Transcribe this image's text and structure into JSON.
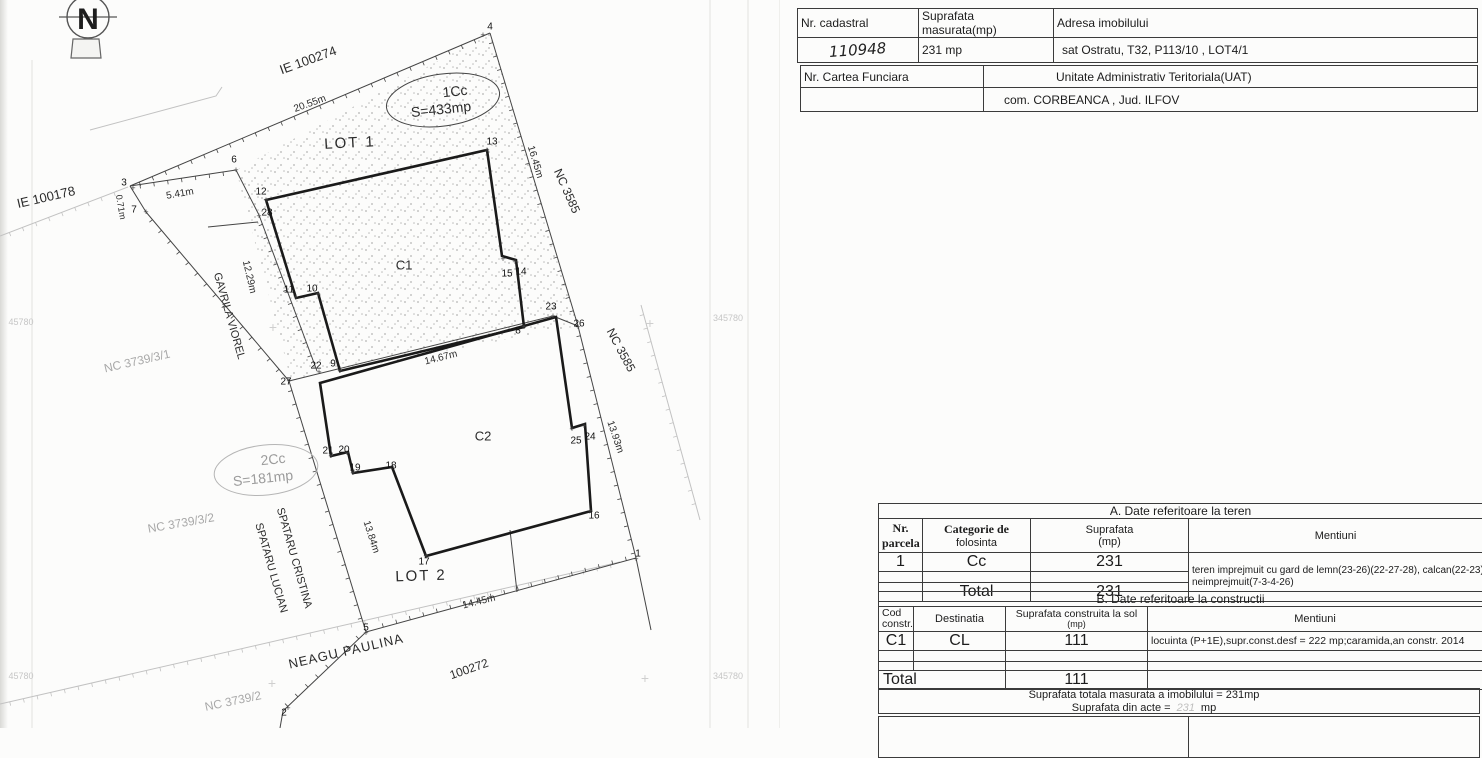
{
  "header_tables": {
    "t1": {
      "headers": [
        "Nr.  cadastral",
        "Suprafata  masurata(mp)",
        "Adresa  imobilului"
      ],
      "values": {
        "nr_cadastral": "110948",
        "suprafata": "231 mp",
        "adresa": "sat Ostratu, T32, P113/10 , LOT4/1"
      }
    },
    "t2": {
      "headers": [
        "Nr. Cartea  Funciara",
        "Unitate Administrativ Teritoriala(UAT)"
      ],
      "values": {
        "cartea_funciara": "",
        "uat": "com. CORBEANCA , Jud. ILFOV"
      }
    }
  },
  "teren": {
    "title": "A.  Date referitoare la teren",
    "col_headers": {
      "nr": [
        "Nr.",
        "parcela"
      ],
      "categorie": [
        "Categorie de",
        "folosinta"
      ],
      "suprafata": [
        "Suprafata",
        "(mp)"
      ],
      "mentiuni": "Mentiuni"
    },
    "row": {
      "nr": "1",
      "categorie": "Cc",
      "suprafata": "231"
    },
    "mentiuni_line1": "teren imprejmuit cu gard de lemn(23-26)(22-27-28), calcan(22-23)(28-6-7) si",
    "mentiuni_line2": "neimprejmuit(7-3-4-26)",
    "total_label": "Total",
    "total": "231"
  },
  "constructii": {
    "title": "B.  Date referitoare la constructii",
    "col_headers": {
      "cod": [
        "Cod",
        "constr."
      ],
      "destinatia": "Destinatia",
      "suprafata": [
        "Suprafata construita la sol",
        "(mp)"
      ],
      "mentiuni": "Mentiuni"
    },
    "row": {
      "cod": "C1",
      "destinatia": "CL",
      "suprafata": "111",
      "mentiuni": "locuinta (P+1E),supr.const.desf = 222 mp;caramida,an constr. 2014"
    },
    "total_label": "Total",
    "total": "111"
  },
  "summary": {
    "line1": "Suprafata  totala  masurata a imobilului =  231mp",
    "line2_prefix": "Suprafata  din  acte =",
    "line2_value": "231",
    "line2_suffix": "mp"
  },
  "map": {
    "north_letter": "N",
    "colors": {
      "ink": "#1a1a1a",
      "boundary": "#444444",
      "faint": "#c2c2c2",
      "gray_text": "#a8a8a8"
    },
    "labels": [
      {
        "text": "IE 100274",
        "x": 308,
        "y": 60,
        "rot": -20,
        "size": 13,
        "name": "neighbor-id-ie100274"
      },
      {
        "text": "20.55m",
        "x": 310,
        "y": 104,
        "rot": -20,
        "size": 10,
        "name": "dim-20-55"
      },
      {
        "text": "LOT 1",
        "x": 350,
        "y": 143,
        "rot": -3,
        "size": 15,
        "ls": 2,
        "name": "lot1-label"
      },
      {
        "text": "IE 100178",
        "x": 46,
        "y": 197,
        "rot": -13,
        "size": 13,
        "name": "neighbor-id-ie100178"
      },
      {
        "text": "5.41m",
        "x": 180,
        "y": 194,
        "rot": -10,
        "size": 10,
        "name": "dim-5-41"
      },
      {
        "text": "0.71m",
        "x": 121,
        "y": 207,
        "rot": 80,
        "size": 9,
        "name": "dim-0-71"
      },
      {
        "text": "12.29m",
        "x": 249,
        "y": 277,
        "rot": 77,
        "size": 10,
        "name": "dim-12-29"
      },
      {
        "text": "GAVRILA VIOREL",
        "x": 229,
        "y": 316,
        "rot": 74,
        "size": 11,
        "name": "neighbor-gavrila-viorel"
      },
      {
        "text": "NC 3739/3/1",
        "x": 137,
        "y": 361,
        "rot": -13,
        "size": 12,
        "color": "#a8a8a8",
        "name": "neighbor-id-nc3739-3-1"
      },
      {
        "text": "16.45m",
        "x": 535,
        "y": 162,
        "rot": 73,
        "size": 10,
        "name": "dim-16-45"
      },
      {
        "text": "NC 3585",
        "x": 567,
        "y": 191,
        "rot": 66,
        "size": 12,
        "name": "neighbor-id-nc3585-a"
      },
      {
        "text": "NC 3585",
        "x": 621,
        "y": 350,
        "rot": 62,
        "size": 12,
        "name": "neighbor-id-nc3585-b"
      },
      {
        "text": "13.93m",
        "x": 615,
        "y": 437,
        "rot": 71,
        "size": 10,
        "name": "dim-13-93"
      },
      {
        "text": "C1",
        "x": 404,
        "y": 265,
        "rot": 0,
        "size": 13,
        "name": "building-c1-label"
      },
      {
        "text": "C2",
        "x": 483,
        "y": 436,
        "rot": 0,
        "size": 13,
        "name": "building-c2-label"
      },
      {
        "text": "14.67m",
        "x": 441,
        "y": 358,
        "rot": -14,
        "size": 10,
        "name": "dim-14-67"
      },
      {
        "text": "1Cc",
        "x": 455,
        "y": 91,
        "rot": -6,
        "size": 14,
        "name": "parcel-1cc-label"
      },
      {
        "text": "S=433mp",
        "x": 441,
        "y": 109,
        "rot": -6,
        "size": 14,
        "name": "parcel-1cc-area"
      },
      {
        "text": "2Cc",
        "x": 273,
        "y": 459,
        "rot": -6,
        "size": 14,
        "color": "#9b9b9b",
        "name": "parcel-2cc-label"
      },
      {
        "text": "S=181mp",
        "x": 263,
        "y": 478,
        "rot": -6,
        "size": 14,
        "color": "#9b9b9b",
        "name": "parcel-2cc-area"
      },
      {
        "text": "SPATARU CRISTINA",
        "x": 294,
        "y": 558,
        "rot": 74,
        "size": 11,
        "name": "neighbor-spataru-cristina"
      },
      {
        "text": "SPATARU LUCIAN",
        "x": 271,
        "y": 568,
        "rot": 74,
        "size": 11,
        "name": "neighbor-spataru-lucian"
      },
      {
        "text": "13.84m",
        "x": 371,
        "y": 537,
        "rot": 72,
        "size": 10,
        "name": "dim-13-84"
      },
      {
        "text": "LOT 2",
        "x": 421,
        "y": 576,
        "rot": -2,
        "size": 15,
        "ls": 2,
        "name": "lot2-label"
      },
      {
        "text": "14.45m",
        "x": 479,
        "y": 602,
        "rot": -14,
        "size": 10,
        "name": "dim-14-45"
      },
      {
        "text": "NEAGU PAULINA",
        "x": 346,
        "y": 651,
        "rot": -13,
        "size": 13,
        "ls": 1,
        "name": "neighbor-neagu-paulina"
      },
      {
        "text": "100272",
        "x": 469,
        "y": 669,
        "rot": -19,
        "size": 12,
        "name": "neighbor-id-100272"
      },
      {
        "text": "NC 3739/2",
        "x": 233,
        "y": 701,
        "rot": -12,
        "size": 12,
        "color": "#a8a8a8",
        "name": "neighbor-id-nc3739-2"
      },
      {
        "text": "NC 3739/3/2",
        "x": 181,
        "y": 523,
        "rot": -10,
        "size": 12,
        "color": "#a8a8a8",
        "name": "neighbor-id-nc3739-3-2"
      },
      {
        "text": "45780",
        "x": 21,
        "y": 322,
        "rot": 0,
        "size": 9,
        "color": "#c6c6c6",
        "name": "grid-coord-label"
      },
      {
        "text": "45780",
        "x": 21,
        "y": 676,
        "rot": 0,
        "size": 9,
        "color": "#c6c6c6",
        "name": "grid-coord-label"
      },
      {
        "text": "345780",
        "x": 728,
        "y": 318,
        "rot": 0,
        "size": 9,
        "color": "#c6c6c6",
        "name": "grid-coord-label"
      },
      {
        "text": "345780",
        "x": 728,
        "y": 676,
        "rot": 0,
        "size": 9,
        "color": "#c6c6c6",
        "name": "grid-coord-label"
      },
      {
        "text": "+",
        "x": 273,
        "y": 327,
        "rot": 0,
        "size": 14,
        "color": "#cfcfcf",
        "name": "grid-cross"
      },
      {
        "text": "+",
        "x": 650,
        "y": 323,
        "rot": 0,
        "size": 14,
        "color": "#cfcfcf",
        "name": "grid-cross"
      },
      {
        "text": "+",
        "x": 272,
        "y": 683,
        "rot": 0,
        "size": 14,
        "color": "#cfcfcf",
        "name": "grid-cross"
      },
      {
        "text": "+",
        "x": 645,
        "y": 678,
        "rot": 0,
        "size": 14,
        "color": "#cfcfcf",
        "name": "grid-cross"
      }
    ],
    "vertices": [
      {
        "n": "3",
        "lx": 124,
        "ly": 183,
        "px": 133,
        "py": 188
      },
      {
        "n": "7",
        "lx": 134,
        "ly": 210,
        "px": 146,
        "py": 212
      },
      {
        "n": "6",
        "lx": 234,
        "ly": 160,
        "px": 236,
        "py": 170
      },
      {
        "n": "4",
        "lx": 490,
        "ly": 27,
        "px": 483,
        "py": 35
      },
      {
        "n": "13",
        "lx": 492,
        "ly": 142,
        "px": 487,
        "py": 150
      },
      {
        "n": "12",
        "lx": 261,
        "ly": 192,
        "px": 266,
        "py": 200
      },
      {
        "n": "28",
        "lx": 267,
        "ly": 213,
        "px": 259,
        "py": 216
      },
      {
        "n": "11",
        "lx": 289,
        "ly": 290,
        "px": 296,
        "py": 297
      },
      {
        "n": "10",
        "lx": 312,
        "ly": 289,
        "px": 318,
        "py": 294
      },
      {
        "n": "15",
        "lx": 507,
        "ly": 274,
        "px": 503,
        "py": 259
      },
      {
        "n": "14",
        "lx": 521,
        "ly": 272,
        "px": 515,
        "py": 262
      },
      {
        "n": "8",
        "lx": 518,
        "ly": 331,
        "px": 524,
        "py": 327
      },
      {
        "n": "23",
        "lx": 551,
        "ly": 307,
        "px": 553,
        "py": 316
      },
      {
        "n": "26",
        "lx": 579,
        "ly": 324,
        "px": 578,
        "py": 327
      },
      {
        "n": "22",
        "lx": 316,
        "ly": 366,
        "px": 319,
        "py": 372
      },
      {
        "n": "9",
        "lx": 333,
        "ly": 364,
        "px": 340,
        "py": 371
      },
      {
        "n": "27",
        "lx": 286,
        "ly": 382,
        "px": 289,
        "py": 381
      },
      {
        "n": "21",
        "lx": 328,
        "ly": 451,
        "px": 331,
        "py": 456
      },
      {
        "n": "20",
        "lx": 344,
        "ly": 450,
        "px": 347,
        "py": 453
      },
      {
        "n": "19",
        "lx": 355,
        "ly": 468,
        "px": 353,
        "py": 473
      },
      {
        "n": "18",
        "lx": 391,
        "ly": 466,
        "px": 392,
        "py": 467
      },
      {
        "n": "25",
        "lx": 576,
        "ly": 441,
        "px": 572,
        "py": 429
      },
      {
        "n": "24",
        "lx": 590,
        "ly": 437,
        "px": 584,
        "py": 426
      },
      {
        "n": "16",
        "lx": 594,
        "ly": 516,
        "px": 590,
        "py": 511
      },
      {
        "n": "17",
        "lx": 424,
        "ly": 562,
        "px": 426,
        "py": 556
      },
      {
        "n": "5",
        "lx": 366,
        "ly": 628,
        "px": 366,
        "py": 633
      },
      {
        "n": "1",
        "lx": 638,
        "ly": 554,
        "px": 636,
        "py": 559
      },
      {
        "n": "2",
        "lx": 284,
        "ly": 713,
        "px": 288,
        "py": 708
      }
    ]
  }
}
